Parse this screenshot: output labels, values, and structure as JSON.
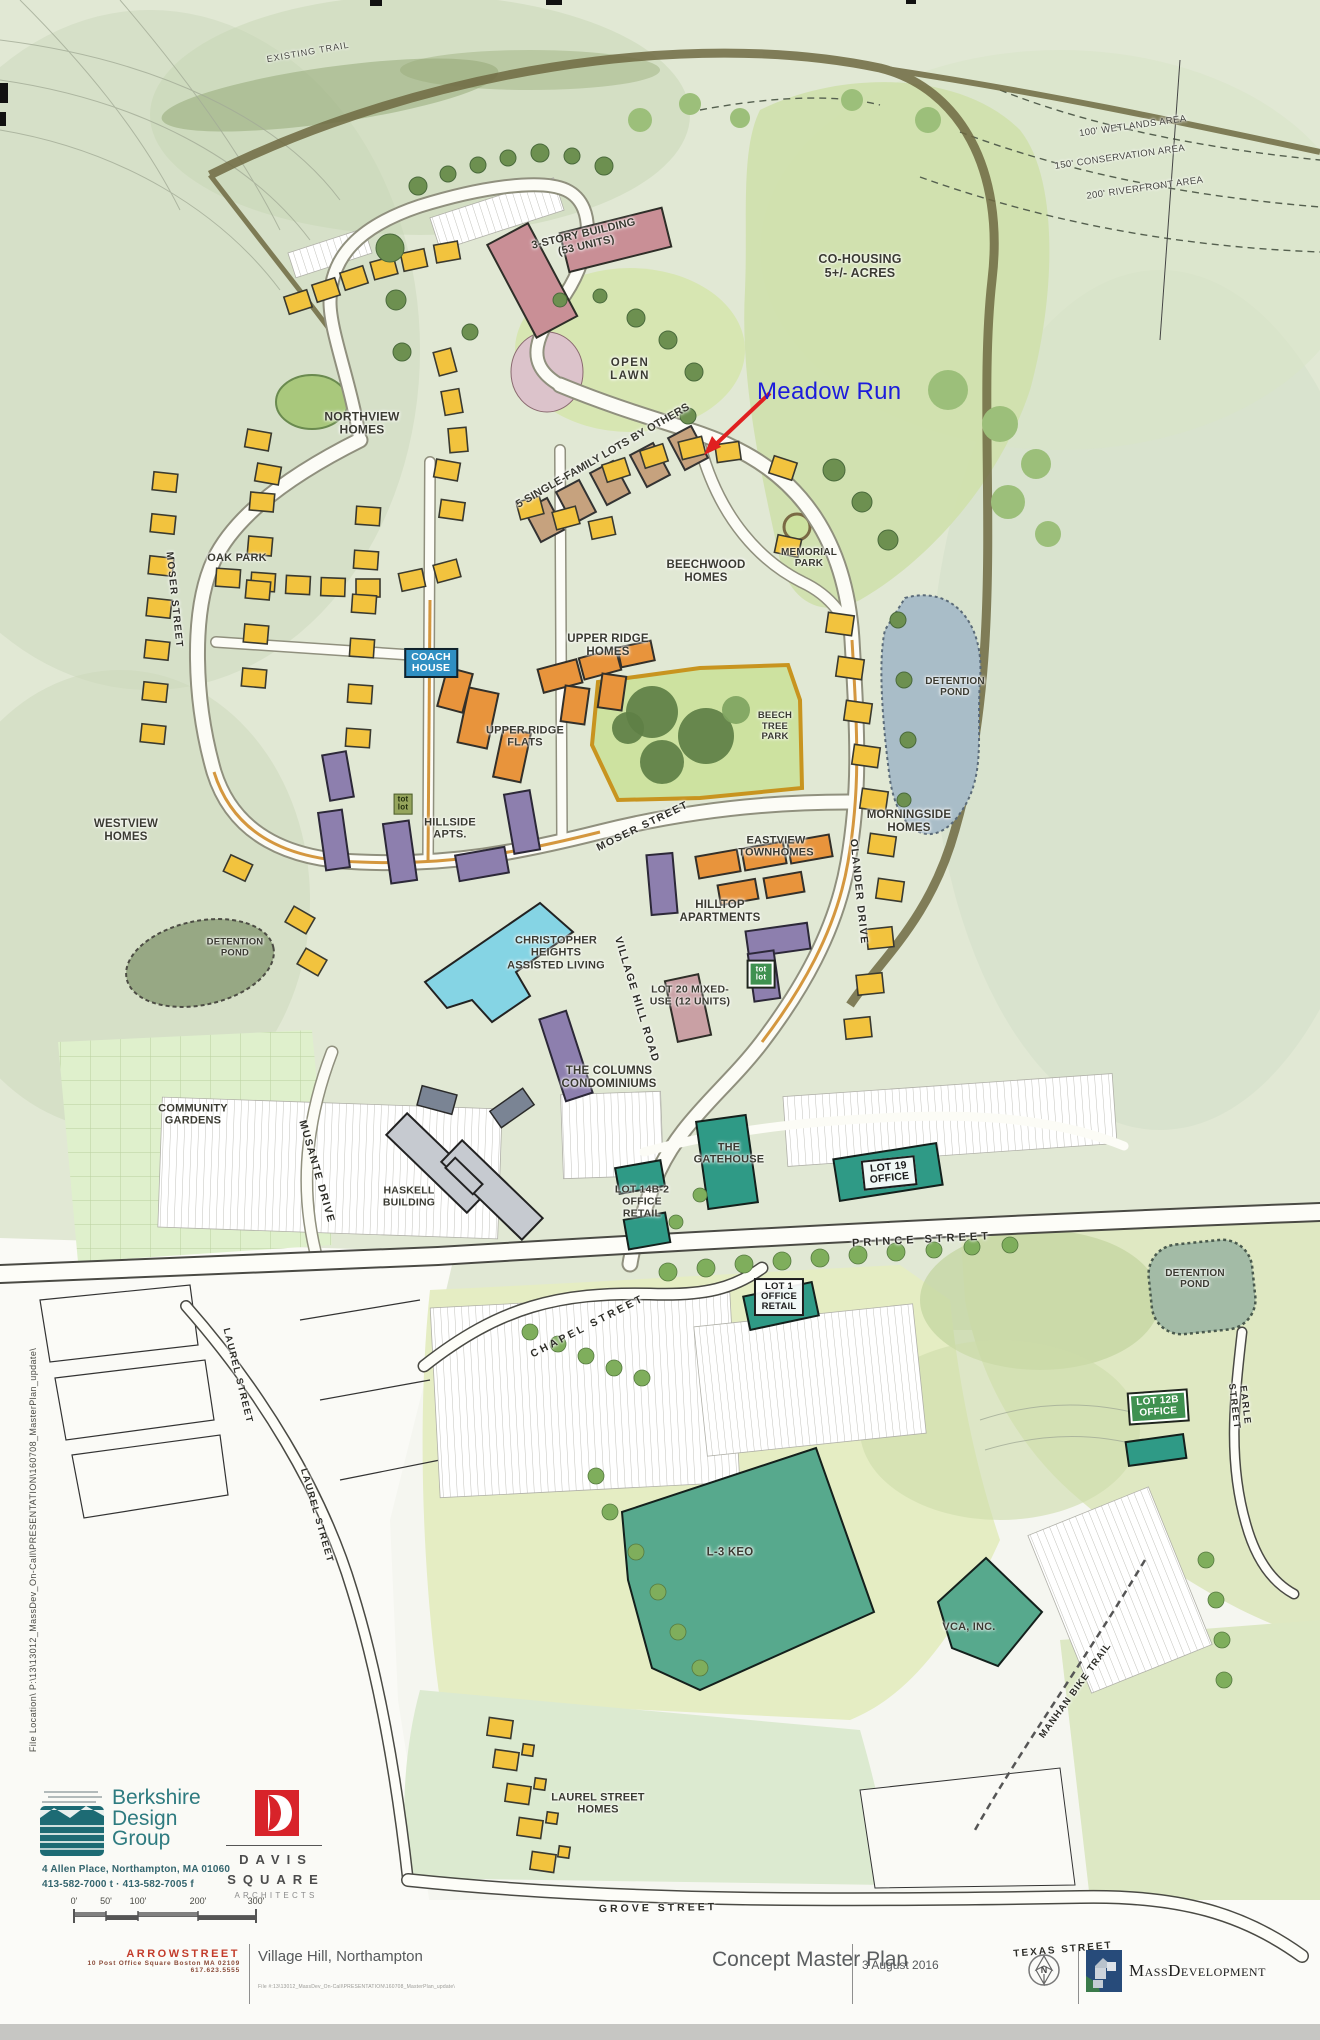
{
  "map_labels": [
    {
      "id": "existing-trail",
      "text": "EXISTING TRAIL"
    },
    {
      "id": "wetlands",
      "text": "100' WETLANDS AREA"
    },
    {
      "id": "conservation",
      "text": "150' CONSERVATION AREA"
    },
    {
      "id": "riverfront",
      "text": "200' RIVERFRONT AREA"
    },
    {
      "id": "co-housing",
      "text": "CO-HOUSING\n5+/- ACRES"
    },
    {
      "id": "three-story-building",
      "text": "3-STORY BUILDING\n(53 UNITS)"
    },
    {
      "id": "open-lawn",
      "text": "OPEN\nLAWN"
    },
    {
      "id": "northview-homes",
      "text": "NORTHVIEW\nHOMES"
    },
    {
      "id": "single-family-lots",
      "text": "5 SINGLE-FAMILY LOTS BY OTHERS"
    },
    {
      "id": "oak-park",
      "text": "OAK PARK"
    },
    {
      "id": "beechwood-homes",
      "text": "BEECHWOOD\nHOMES"
    },
    {
      "id": "memorial-park",
      "text": "MEMORIAL\nPARK"
    },
    {
      "id": "coach-house",
      "text": "COACH\nHOUSE"
    },
    {
      "id": "upper-ridge-homes",
      "text": "UPPER RIDGE\nHOMES"
    },
    {
      "id": "upper-ridge-flats",
      "text": "UPPER RIDGE\nFLATS"
    },
    {
      "id": "beech-tree-park",
      "text": "BEECH\nTREE\nPARK"
    },
    {
      "id": "westview-homes",
      "text": "WESTVIEW\nHOMES"
    },
    {
      "id": "moser-street-west",
      "text": "MOSER STREET"
    },
    {
      "id": "moser-street-east",
      "text": "MOSER STREET"
    },
    {
      "id": "eastview-townhomes",
      "text": "EASTVIEW\nTOWNHOMES"
    },
    {
      "id": "morningside-homes",
      "text": "MORNINGSIDE\nHOMES"
    },
    {
      "id": "detention-pond-ne",
      "text": "DETENTION\nPOND"
    },
    {
      "id": "hillside-apts",
      "text": "HILLSIDE\nAPTS."
    },
    {
      "id": "tot-lot-upper",
      "text": "tot\nlot"
    },
    {
      "id": "detention-pond-west",
      "text": "DETENTION\nPOND"
    },
    {
      "id": "hilltop-apartments",
      "text": "HILLTOP\nAPARTMENTS"
    },
    {
      "id": "tot-lot-lower",
      "text": "tot\nlot"
    },
    {
      "id": "lot-20",
      "text": "LOT 20 MIXED-\nUSE (12 UNITS)"
    },
    {
      "id": "olander-drive",
      "text": "OLANDER DRIVE"
    },
    {
      "id": "village-hill-road",
      "text": "VILLAGE HILL ROAD"
    },
    {
      "id": "christopher-heights",
      "text": "CHRISTOPHER\nHEIGHTS\nASSISTED LIVING"
    },
    {
      "id": "the-columns",
      "text": "THE COLUMNS\nCONDOMINIUMS"
    },
    {
      "id": "community-gardens",
      "text": "COMMUNITY\nGARDENS"
    },
    {
      "id": "musante-drive",
      "text": "MUSANTE DRIVE"
    },
    {
      "id": "haskell-building",
      "text": "HASKELL\nBUILDING"
    },
    {
      "id": "the-gatehouse",
      "text": "THE\nGATEHOUSE"
    },
    {
      "id": "lot-14b2",
      "text": "LOT 14B-2\nOFFICE\nRETAIL"
    },
    {
      "id": "lot-19",
      "text": "LOT 19\nOFFICE"
    },
    {
      "id": "prince-street",
      "text": "PRINCE STREET"
    },
    {
      "id": "detention-pond-se",
      "text": "DETENTION\nPOND"
    },
    {
      "id": "chapel-street",
      "text": "CHAPEL STREET"
    },
    {
      "id": "lot-1",
      "text": "LOT 1\nOFFICE\nRETAIL"
    },
    {
      "id": "laurel-street-upper",
      "text": "LAUREL STREET"
    },
    {
      "id": "laurel-street-lower",
      "text": "LAUREL STREET"
    },
    {
      "id": "lot-12b",
      "text": "LOT 12B\nOFFICE"
    },
    {
      "id": "earle-street",
      "text": "EARLE STREET"
    },
    {
      "id": "l3-keo",
      "text": "L-3 KEO"
    },
    {
      "id": "vca-inc",
      "text": "VCA, INC."
    },
    {
      "id": "manhan-bike-trail",
      "text": "MANHAN BIKE TRAIL"
    },
    {
      "id": "laurel-street-homes",
      "text": "LAUREL STREET\nHOMES"
    },
    {
      "id": "grove-street",
      "text": "GROVE STREET"
    },
    {
      "id": "texas-street",
      "text": "TEXAS STREET"
    }
  ],
  "annotation": {
    "meadow_run": "Meadow Run"
  },
  "side_note": "File Location\\  P:\\13\\13012_MassDev_On-Call\\PRESENTATION\\160708_MasterPlan_update\\",
  "title_block": {
    "project": "Village Hill, Northampton",
    "sheet": "Concept Master Plan",
    "date": "3 August 2016",
    "file_note": "File #:13\\13012_MassDev_On-Call\\PRESENTATION\\160708_MasterPlan_update\\",
    "massdev": "MassDevelopment",
    "north": "N"
  },
  "firms": {
    "berkshire": {
      "name": "Berkshire\nDesign\nGroup",
      "address": "4 Allen Place, Northampton, MA 01060",
      "phones": "413-582-7000 t    ·    413-582-7005 f"
    },
    "davis": {
      "name": "DAVIS\nSQUARE",
      "sub": "ARCHITECTS"
    },
    "arrowstreet": {
      "name": "ARROWSTREET",
      "address": "10 Post Office Square  Boston  MA  02109",
      "phone": "617.623.5555"
    }
  },
  "scale_bar": {
    "labels": [
      "0'",
      "50'",
      "100'",
      "200'",
      "300'"
    ]
  },
  "colors": {
    "single_family_yellow": "#f2c33e",
    "townhome_orange": "#e8943c",
    "apartment_purple": "#8d7fae",
    "assisted_living_cyan": "#85d4e4",
    "office_teal": "#2f9a86",
    "mixed_use_pink": "#c9a0a4",
    "annotation_blue": "#1c1cdc",
    "annotation_arrow_red": "#e02020"
  }
}
